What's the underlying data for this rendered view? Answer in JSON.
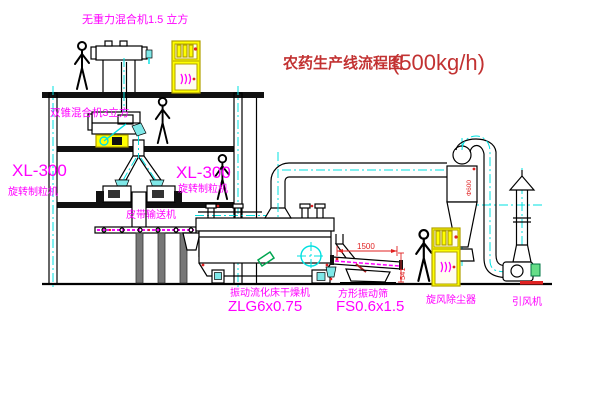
{
  "diagram": {
    "title": "农药生产线流程图",
    "title_capacity": "(500kg/h)"
  },
  "labels": {
    "top_mixer": "无重力混合机1.5 立方",
    "second_mixer": "双锥混合机3立方",
    "granulator_left_model": "XL-300",
    "granulator_left_name": "旋转制粒机",
    "granulator_mid_model": "XL-300",
    "granulator_mid_name": "旋转制粒机",
    "belt_conveyor": "皮带输送机",
    "dryer_name": "振动流化床干燥机",
    "dryer_model": "ZLG6x0.75",
    "screen_name": "方形振动筛",
    "screen_model": "FS0.6x1.5",
    "cyclone_name": "旋风除尘器",
    "fan_name": "引风机"
  },
  "dimensions": {
    "screen_length": "1500",
    "screen_height": "541",
    "cyclone_diameter": "Φ600"
  },
  "colors": {
    "label_magenta": "#ff00ff",
    "title_red": "#c23232",
    "dimension_red": "#e02222",
    "centerline_cyan": "#00e0e0",
    "cabinet_yellow": "#ffff00",
    "line_black": "#000000"
  }
}
